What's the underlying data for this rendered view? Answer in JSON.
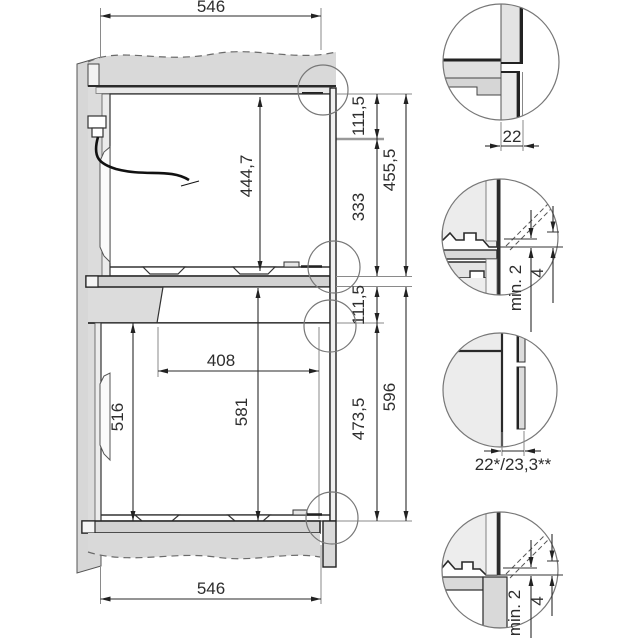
{
  "drawing": {
    "dim_top_width": "546",
    "dim_bottom_width": "546",
    "dim_upper_niche_height": "444,7",
    "dim_upper_front_offset": "111,5",
    "dim_upper_inner_height": "333",
    "dim_upper_total_height": "455,5",
    "dim_lower_front_offset": "111,5",
    "dim_lower_inner_height": "473,5",
    "dim_lower_total_height": "596",
    "dim_lower_cutout_width": "408",
    "dim_lower_niche_height": "516",
    "dim_lower_appliance_height": "581"
  },
  "details": {
    "front_thickness": "22",
    "front_thickness_variants": "22*/23,3**",
    "min_gap": "min. 2",
    "vent_gap": "4"
  },
  "colors": {
    "background": "#ffffff",
    "panel_gray": "#dcdcdc",
    "outline_dark": "#2a2a2a",
    "dimension_text": "#2d2d2d"
  }
}
